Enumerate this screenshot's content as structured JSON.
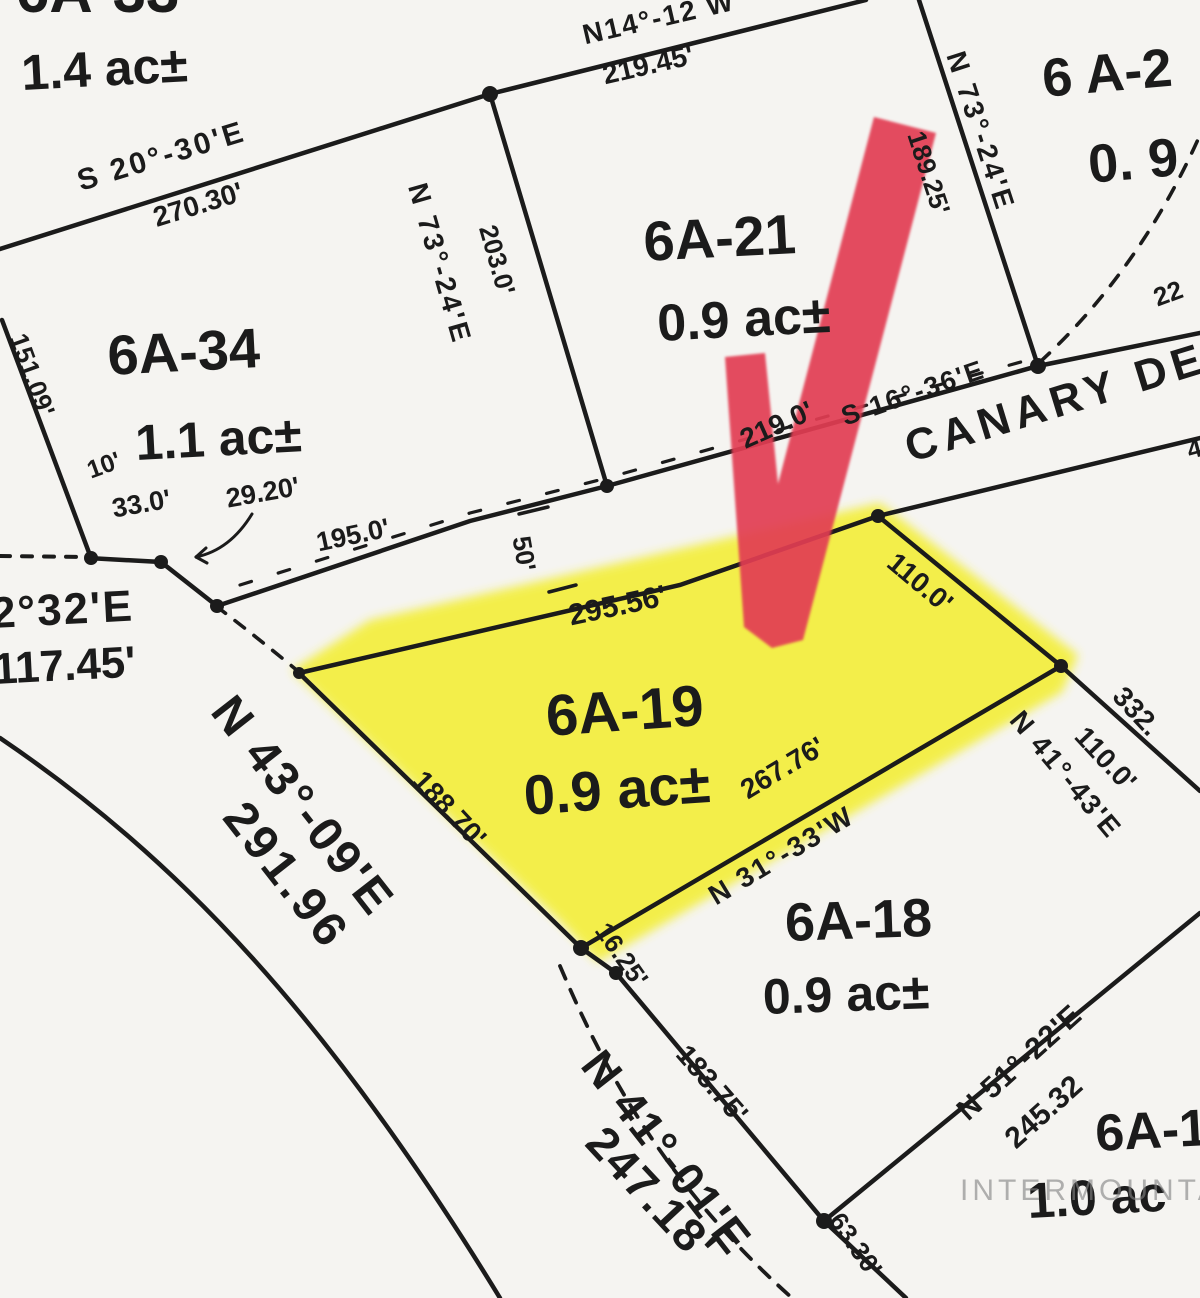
{
  "document": {
    "type": "plat-survey-map",
    "highlighted_parcel": "6A-19"
  },
  "watermark": {
    "text": "INTERMOUNTAIN"
  },
  "street": {
    "visible_name": "CANARY DE"
  },
  "map": {
    "background": "#f5f4f1",
    "ink": "#1b1b1b",
    "highlight_color": "#f3ee2e",
    "arrow_color": "#e23c52",
    "highlight_points": "292,670 370,620 880,503 1078,655 1062,692 598,962 560,922",
    "arrow_points": "725,357 765,353 778,484 874,117 936,133 803,640 772,648 744,627",
    "lines": [
      {
        "d": "M0,249 L490,94",
        "w": 4.5
      },
      {
        "d": "M490,94 L866,0",
        "w": 4.5
      },
      {
        "d": "M490,94 L607,486",
        "w": 4.5
      },
      {
        "d": "M919,0 L1038,366",
        "w": 4.5
      },
      {
        "d": "M88,558 L161,562 L217,606 L470,521 L607,486 L1038,366 L1200,333",
        "w": 4.5
      },
      {
        "d": "M2,320 L91,558",
        "w": 4.5
      },
      {
        "d": "M299,673 L680,585 L878,516",
        "w": 4.5
      },
      {
        "d": "M878,516 L1200,438",
        "w": 4.5
      },
      {
        "d": "M878,516 L1061,666",
        "w": 4.5
      },
      {
        "d": "M1061,666 L1200,791",
        "w": 4.5
      },
      {
        "d": "M299,673 L581,948",
        "w": 4.5
      },
      {
        "d": "M581,948 L1061,666",
        "w": 4.5
      },
      {
        "d": "M581,948 L616,973",
        "w": 4.5
      },
      {
        "d": "M616,973 L824,1221",
        "w": 4.5
      },
      {
        "d": "M824,1221 L906,1298",
        "w": 4.5
      },
      {
        "d": "M824,1221 L1200,913",
        "w": 4.5
      },
      {
        "d": "M0,738 C180,860 330,1020 500,1298",
        "w": 4.5
      },
      {
        "d": "M519,514 L548,507",
        "w": 3.5
      },
      {
        "d": "M549,592 L576,585",
        "w": 3.5
      },
      {
        "d": "M252,514 Q230,550 196,557",
        "w": 3
      },
      {
        "d": "M196,557 L206,548",
        "w": 3
      },
      {
        "d": "M196,557 L207,563",
        "w": 3
      },
      {
        "d": "M0,556 L88,557",
        "w": 4,
        "dash": "10 12"
      },
      {
        "d": "M240,585 L470,513 L607,478 L1035,358",
        "w": 3.2,
        "dash": "12 28"
      },
      {
        "d": "M216,606 Q258,638 299,672",
        "w": 3.6,
        "dash": "12 12"
      },
      {
        "d": "M1040,362 Q1140,270 1200,135",
        "w": 3.6,
        "dash": "13 13"
      },
      {
        "d": "M560,966 C600,1060 660,1180 792,1298",
        "w": 3.8,
        "dash": "14 12"
      }
    ],
    "dots": [
      [
        490,
        94,
        8
      ],
      [
        607,
        486,
        7
      ],
      [
        1038,
        366,
        8
      ],
      [
        91,
        558,
        7
      ],
      [
        161,
        562,
        7
      ],
      [
        217,
        606,
        7
      ],
      [
        299,
        673,
        6
      ],
      [
        878,
        516,
        7
      ],
      [
        1061,
        666,
        7
      ],
      [
        581,
        948,
        8
      ],
      [
        616,
        973,
        7
      ],
      [
        824,
        1221,
        8
      ]
    ],
    "labels": [
      {
        "n": "parcel-6a33",
        "t": "6A-33",
        "x": 16,
        "y": -38,
        "r": 0,
        "s": 60
      },
      {
        "n": "area-6a33",
        "t": "1.4 ac±",
        "x": 20,
        "y": 48,
        "r": -3,
        "s": 50
      },
      {
        "n": "parcel-6a34",
        "t": "6A-34",
        "x": 106,
        "y": 328,
        "r": -3,
        "s": 56
      },
      {
        "n": "area-6a34",
        "t": "1.1 ac±",
        "x": 134,
        "y": 418,
        "r": -3,
        "s": 50
      },
      {
        "n": "parcel-6a21",
        "t": "6A-21",
        "x": 642,
        "y": 214,
        "r": -3,
        "s": 56
      },
      {
        "n": "area-6a21",
        "t": "0.9 ac±",
        "x": 656,
        "y": 298,
        "r": -3,
        "s": 52
      },
      {
        "n": "parcel-6a19",
        "t": "6A-19",
        "x": 544,
        "y": 688,
        "r": -4,
        "s": 58
      },
      {
        "n": "area-6a19",
        "t": "0.9 ac±",
        "x": 522,
        "y": 768,
        "r": -4,
        "s": 56
      },
      {
        "n": "parcel-6a18",
        "t": "6A-18",
        "x": 784,
        "y": 896,
        "r": -2,
        "s": 54
      },
      {
        "n": "area-6a18",
        "t": "0.9 ac±",
        "x": 762,
        "y": 972,
        "r": -2,
        "s": 50
      },
      {
        "n": "parcel-6a2x",
        "t": "6 A-2",
        "x": 1040,
        "y": 52,
        "r": -5,
        "s": 54
      },
      {
        "n": "area-6a2x",
        "t": "0. 9",
        "x": 1086,
        "y": 138,
        "r": -5,
        "s": 54
      },
      {
        "n": "parcel-6a1x",
        "t": "6A-1",
        "x": 1094,
        "y": 1108,
        "r": -3,
        "s": 52
      },
      {
        "n": "area-6a1x",
        "t": "1.0 ac",
        "x": 1026,
        "y": 1176,
        "r": -3,
        "s": 50
      },
      {
        "n": "bearing-s20-30e",
        "t": "S 20°-30'E",
        "x": 74,
        "y": 168,
        "r": -17,
        "s": 30,
        "ls": 3
      },
      {
        "n": "dist-270-30",
        "t": "270.30'",
        "x": 150,
        "y": 205,
        "r": -17,
        "s": 28
      },
      {
        "n": "bearing-n14-12w",
        "t": "N14°-12 W",
        "x": 580,
        "y": 22,
        "r": -13,
        "s": 28,
        "ls": 2
      },
      {
        "n": "dist-219-45",
        "t": "219.45'",
        "x": 600,
        "y": 62,
        "r": -13,
        "s": 28
      },
      {
        "n": "bearing-n73-24e-left",
        "t": "N 73°-24'E",
        "x": 430,
        "y": 180,
        "r": 74,
        "s": 28,
        "ls": 3
      },
      {
        "n": "dist-203-0",
        "t": "203.0'",
        "x": 500,
        "y": 222,
        "r": 74,
        "s": 26
      },
      {
        "n": "bearing-n73-24e-right",
        "t": "N 73°-24'E",
        "x": 968,
        "y": 48,
        "r": 72,
        "s": 28,
        "ls": 3
      },
      {
        "n": "dist-189-25",
        "t": "189.25'",
        "x": 928,
        "y": 128,
        "r": 72,
        "s": 26
      },
      {
        "n": "dist-219-0",
        "t": "219.0'",
        "x": 736,
        "y": 428,
        "r": -24,
        "s": 28
      },
      {
        "n": "bearing-s16-36e",
        "t": "S 16°-36'E",
        "x": 838,
        "y": 405,
        "r": -19,
        "s": 27,
        "ls": 2
      },
      {
        "n": "street-canary",
        "t": "CANARY DE",
        "x": 900,
        "y": 428,
        "r": -17,
        "s": 44,
        "ls": 6
      },
      {
        "n": "dist-22",
        "t": "22",
        "x": 1150,
        "y": 286,
        "r": -20,
        "s": 26
      },
      {
        "n": "frag-4",
        "t": "4",
        "x": 1184,
        "y": 438,
        "r": -15,
        "s": 26
      },
      {
        "n": "dist-195-0",
        "t": "195.0'",
        "x": 314,
        "y": 530,
        "r": -12,
        "s": 27
      },
      {
        "n": "dist-33-0",
        "t": "33.0'",
        "x": 110,
        "y": 496,
        "r": -10,
        "s": 27
      },
      {
        "n": "dist-29-20",
        "t": "29.20'",
        "x": 224,
        "y": 486,
        "r": -10,
        "s": 27
      },
      {
        "n": "dist-10",
        "t": "10'",
        "x": 84,
        "y": 460,
        "r": -20,
        "s": 25
      },
      {
        "n": "dist-151-09",
        "t": "151.09'",
        "x": 30,
        "y": 330,
        "r": 70,
        "s": 26
      },
      {
        "n": "bearing-2-32e",
        "t": "2°32'E",
        "x": -10,
        "y": 592,
        "r": -3,
        "s": 44,
        "ls": 2
      },
      {
        "n": "dist-117-45",
        "t": "117.45'",
        "x": -8,
        "y": 648,
        "r": -3,
        "s": 44
      },
      {
        "n": "bearing-n43-09e",
        "t": "N 43°-09'E",
        "x": 240,
        "y": 688,
        "r": 52,
        "s": 48,
        "ls": 3
      },
      {
        "n": "dist-291-96",
        "t": "291.96",
        "x": 252,
        "y": 794,
        "r": 52,
        "s": 48,
        "ls": 4
      },
      {
        "n": "dist-188-70",
        "t": "188.70'",
        "x": 428,
        "y": 766,
        "r": 47,
        "s": 28
      },
      {
        "n": "dist-295-56",
        "t": "295.56'",
        "x": 566,
        "y": 602,
        "r": -12,
        "s": 30
      },
      {
        "n": "dist-110-0-road",
        "t": "110.0'",
        "x": 900,
        "y": 548,
        "r": 40,
        "s": 28
      },
      {
        "n": "dist-267-76",
        "t": "267.76'",
        "x": 736,
        "y": 780,
        "r": -31,
        "s": 28
      },
      {
        "n": "bearing-n31-33w",
        "t": "N 31°-33'W",
        "x": 704,
        "y": 886,
        "r": -31,
        "s": 28,
        "ls": 2
      },
      {
        "n": "dist-16-25",
        "t": "16.25'",
        "x": 612,
        "y": 918,
        "r": 55,
        "s": 26
      },
      {
        "n": "dist-183-75",
        "t": "183.75'",
        "x": 692,
        "y": 1040,
        "r": 49,
        "s": 28
      },
      {
        "n": "bearing-n41-01e",
        "t": "N 41°-01'E",
        "x": 610,
        "y": 1042,
        "r": 52,
        "s": 46,
        "ls": 2
      },
      {
        "n": "dist-247-18",
        "t": "247.18'",
        "x": 612,
        "y": 1118,
        "r": 47,
        "s": 46,
        "ls": 2
      },
      {
        "n": "dist-63-30",
        "t": "63.30'",
        "x": 846,
        "y": 1208,
        "r": 55,
        "s": 26
      },
      {
        "n": "bearing-n51-22e",
        "t": "N 51°-22'E",
        "x": 952,
        "y": 1104,
        "r": -42,
        "s": 30,
        "ls": 1
      },
      {
        "n": "dist-245-32",
        "t": "245.32",
        "x": 1000,
        "y": 1132,
        "r": -42,
        "s": 30
      },
      {
        "n": "dist-332",
        "t": "332.",
        "x": 1128,
        "y": 682,
        "r": 47,
        "s": 28
      },
      {
        "n": "dist-110-0-east",
        "t": "110.0'",
        "x": 1090,
        "y": 722,
        "r": 47,
        "s": 28
      },
      {
        "n": "bearing-n41-43e",
        "t": "N 41°-43'E",
        "x": 1026,
        "y": 706,
        "r": 50,
        "s": 28,
        "ls": 2
      },
      {
        "n": "dist-50",
        "t": "50'",
        "x": 534,
        "y": 534,
        "r": 80,
        "s": 26
      }
    ]
  }
}
